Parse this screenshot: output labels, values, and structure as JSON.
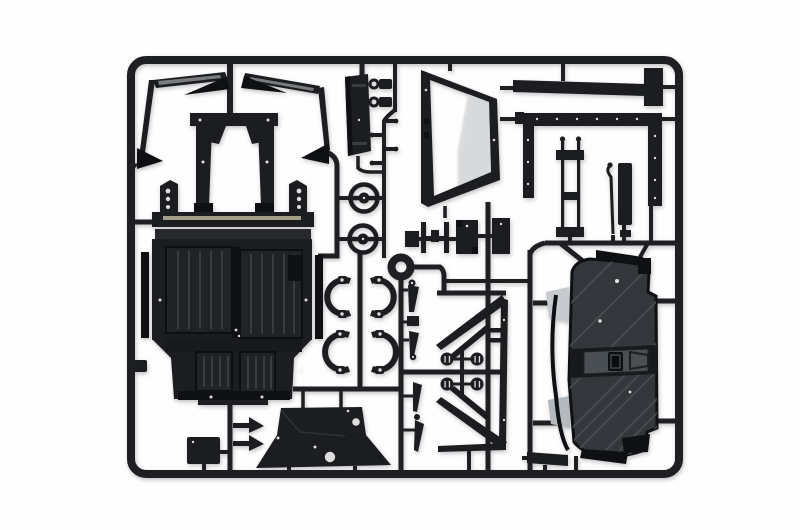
{
  "image": {
    "type": "product-photo",
    "subject": "Black injection-molded plastic model-kit sprue (parts tree) with car body parts, photographed on a white studio background",
    "text_visible": "none"
  },
  "colors": {
    "bg": "#fefefe",
    "runner": "#1d1f22",
    "plastic": "#1b1d20",
    "plastic_dark": "#0f1013",
    "plastic_mid": "#27292d",
    "rib_panel": "#202326",
    "rib_line": "#383c41",
    "panel_gray": "#33373b",
    "ridge_gray": "#474c51",
    "band_dark": "#17191b",
    "plate_gray": "#4a4f54",
    "highlight_gray": "#c7cbd0",
    "highlight_gray2": "#b4b9be",
    "tan_edge": "#a39f87",
    "sheen_gray": "#d8dbde"
  },
  "parts": {
    "frame": "rectangular outer sprue frame with rounded corners and internal runner gates",
    "list": [
      {
        "id": "pillar-rail-left",
        "desc": "angled windshield pillar rail with blade, left"
      },
      {
        "id": "pillar-rail-right",
        "desc": "angled windshield pillar rail with blade, right"
      },
      {
        "id": "bulkhead-frame",
        "desc": "central seat/bulkhead frame with open center"
      },
      {
        "id": "mount-plate-left",
        "desc": "drilled mounting bracket plate, left"
      },
      {
        "id": "mount-plate-right",
        "desc": "drilled mounting bracket plate, right"
      },
      {
        "id": "floor-pan",
        "desc": "large ribbed cab floor pan"
      },
      {
        "id": "pulley-wheel-upper",
        "desc": "round hub/pulley part, upper"
      },
      {
        "id": "pulley-wheel-lower",
        "desc": "round hub/pulley part, lower"
      },
      {
        "id": "sprue-ring-junction",
        "desc": "circular runner junction ring"
      },
      {
        "id": "fender-bracket-pair-upper",
        "desc": "pair of curved C-brackets, upper"
      },
      {
        "id": "fender-bracket-pair-lower",
        "desc": "pair of curved C-brackets, lower"
      },
      {
        "id": "lever-parts-column",
        "desc": "column of tapered lever/mount parts"
      },
      {
        "id": "window-frame",
        "desc": "trapezoidal window frame with open center"
      },
      {
        "id": "roof-bar",
        "desc": "long roof bar with T end cap"
      },
      {
        "id": "door-frame",
        "desc": "portal door frame with riveted legs"
      },
      {
        "id": "radius-rod-assembly",
        "desc": "twin parallel rods with end blocks"
      },
      {
        "id": "shift-lever",
        "desc": "thin bent lever rod"
      },
      {
        "id": "side-strip",
        "desc": "small vertical strip part"
      },
      {
        "id": "tailgate-panel",
        "desc": "narrow vertical tailgate panel"
      },
      {
        "id": "mirror-clips",
        "desc": "two ring-headed clip parts"
      },
      {
        "id": "pedal-blades",
        "desc": "twin-blade pedal part"
      },
      {
        "id": "block-part-stepped",
        "desc": "stepped block part"
      },
      {
        "id": "block-part-plain",
        "desc": "plain block part"
      },
      {
        "id": "chassis-diagonals-upper",
        "desc": "tapered diagonal chassis rails, upper pair"
      },
      {
        "id": "chassis-diagonals-lower",
        "desc": "tapered diagonal chassis rails, lower pair"
      },
      {
        "id": "drum-hubs",
        "desc": "four round drum hubs on cross runner"
      },
      {
        "id": "side-rail",
        "desc": "long vertical chassis side rail"
      },
      {
        "id": "firewall-cowl",
        "desc": "wide trapezoidal firewall/cowl with round hole"
      },
      {
        "id": "arrow-clip-1",
        "desc": "arrow-shaped clip part"
      },
      {
        "id": "arrow-clip-2",
        "desc": "arrow-shaped clip part"
      },
      {
        "id": "small-plate",
        "desc": "small rectangular plate"
      },
      {
        "id": "sill-bar",
        "desc": "short sill bar part"
      },
      {
        "id": "rear-body-panel",
        "desc": "large diagonally-ribbed rear body panel with latch band and gray hinge wedges"
      }
    ]
  }
}
